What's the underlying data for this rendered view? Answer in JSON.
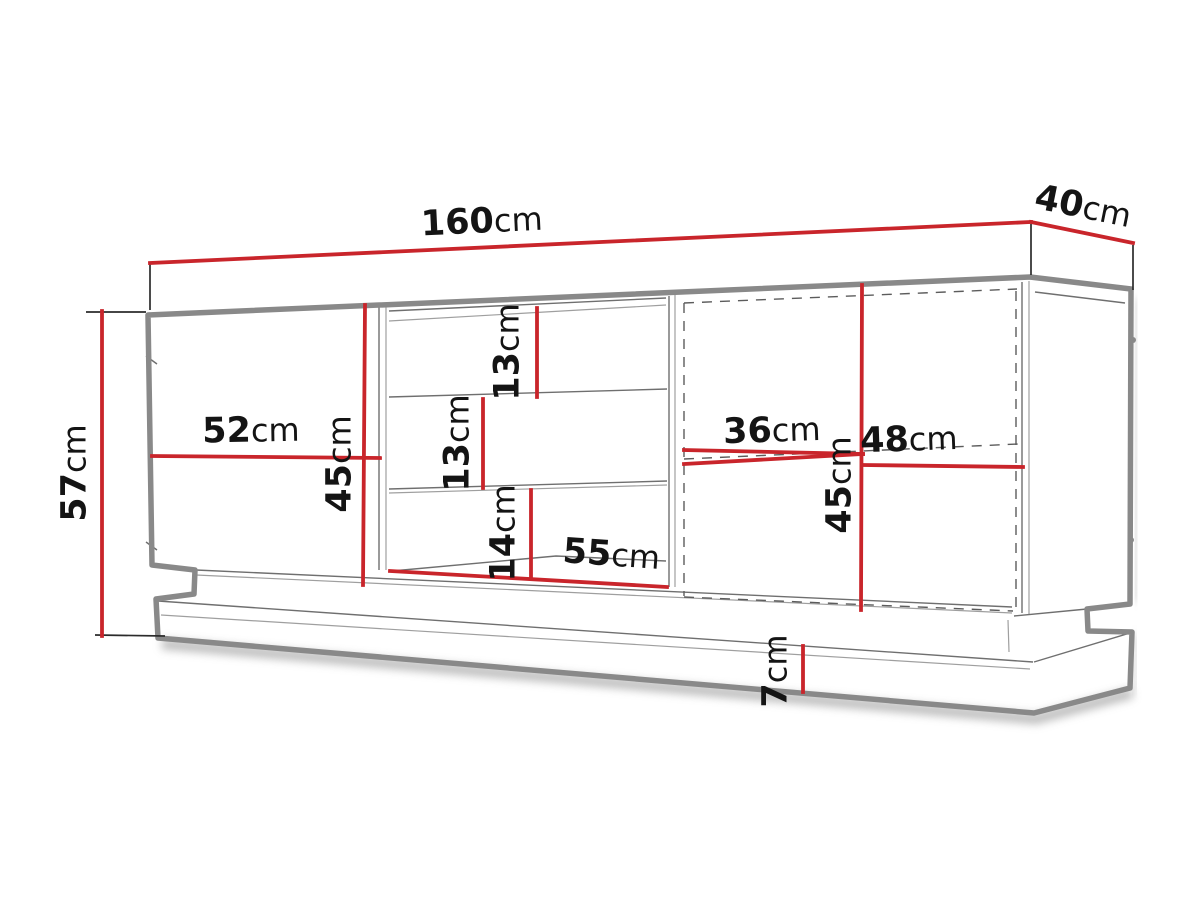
{
  "diagram": {
    "type": "furniture-dimension-drawing",
    "labels": {
      "total_width": {
        "value": "160",
        "unit": "cm"
      },
      "depth": {
        "value": "40",
        "unit": "cm"
      },
      "total_height": {
        "value": "57",
        "unit": "cm"
      },
      "left_door_width": {
        "value": "52",
        "unit": "cm"
      },
      "left_section_height": {
        "value": "45",
        "unit": "cm"
      },
      "top_shelf_height": {
        "value": "13",
        "unit": "cm"
      },
      "middle_shelf_height": {
        "value": "13",
        "unit": "cm"
      },
      "bottom_shelf_height": {
        "value": "14",
        "unit": "cm"
      },
      "shelf_width": {
        "value": "55",
        "unit": "cm"
      },
      "right_inner_width": {
        "value": "36",
        "unit": "cm"
      },
      "right_door_width": {
        "value": "48",
        "unit": "cm"
      },
      "right_section_height": {
        "value": "45",
        "unit": "cm"
      },
      "plinth_height": {
        "value": "7",
        "unit": "cm"
      }
    },
    "colors": {
      "dimension": "#c9252b",
      "outline": "#898989",
      "detail_line": "#6f6f6f",
      "text": "#141414",
      "background": "#ffffff"
    }
  }
}
